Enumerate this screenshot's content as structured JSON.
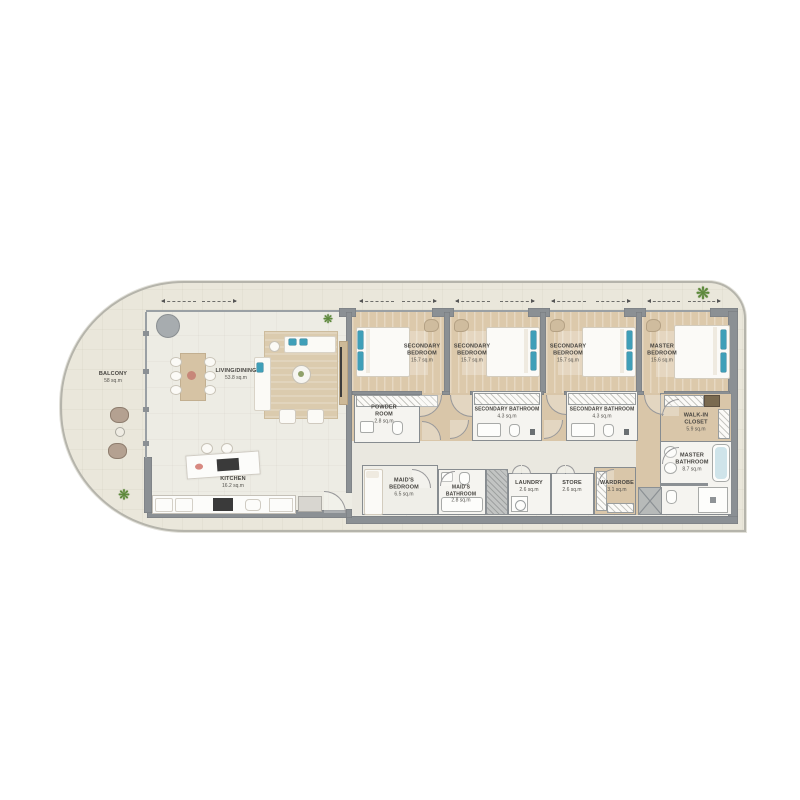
{
  "plan_title": "4-bedroom apartment floor plan",
  "rooms": [
    {
      "name": "BALCONY",
      "area": "58 sq.m"
    },
    {
      "name": "LIVING/DINING",
      "area": "53.8 sq.m"
    },
    {
      "name": "KITCHEN",
      "area": "16.2 sq.m"
    },
    {
      "name": "SECONDARY BEDROOM",
      "area": "15.7 sq.m"
    },
    {
      "name": "SECONDARY BEDROOM",
      "area": "15.7 sq.m"
    },
    {
      "name": "SECONDARY BEDROOM",
      "area": "15.7 sq.m"
    },
    {
      "name": "MASTER BEDROOM",
      "area": "15.6 sq.m"
    },
    {
      "name": "POWDER ROOM",
      "area": "2.8 sq.m"
    },
    {
      "name": "SECONDARY BATHROOM",
      "area": "4.3 sq.m"
    },
    {
      "name": "SECONDARY BATHROOM",
      "area": "4.3 sq.m"
    },
    {
      "name": "WALK-IN CLOSET",
      "area": "5.9 sq.m"
    },
    {
      "name": "MAID'S BEDROOM",
      "area": "6.5 sq.m"
    },
    {
      "name": "MAID'S BATHROOM",
      "area": "2.8 sq.m"
    },
    {
      "name": "LAUNDRY",
      "area": "2.6 sq.m"
    },
    {
      "name": "STORE",
      "area": "2.6 sq.m"
    },
    {
      "name": "WARDROBE",
      "area": "3.1 sq.m"
    },
    {
      "name": "MASTER BATHROOM",
      "area": "8.7 sq.m"
    }
  ],
  "icons": {
    "palm": "❋"
  },
  "colors": {
    "wall": "#8b9094",
    "accent_teal": "#3f9fb8",
    "floor_tan": "#dcc9ab",
    "floor_cream": "#eae7db",
    "floor_light": "#edece4",
    "boundary": "#b5b4ab"
  }
}
